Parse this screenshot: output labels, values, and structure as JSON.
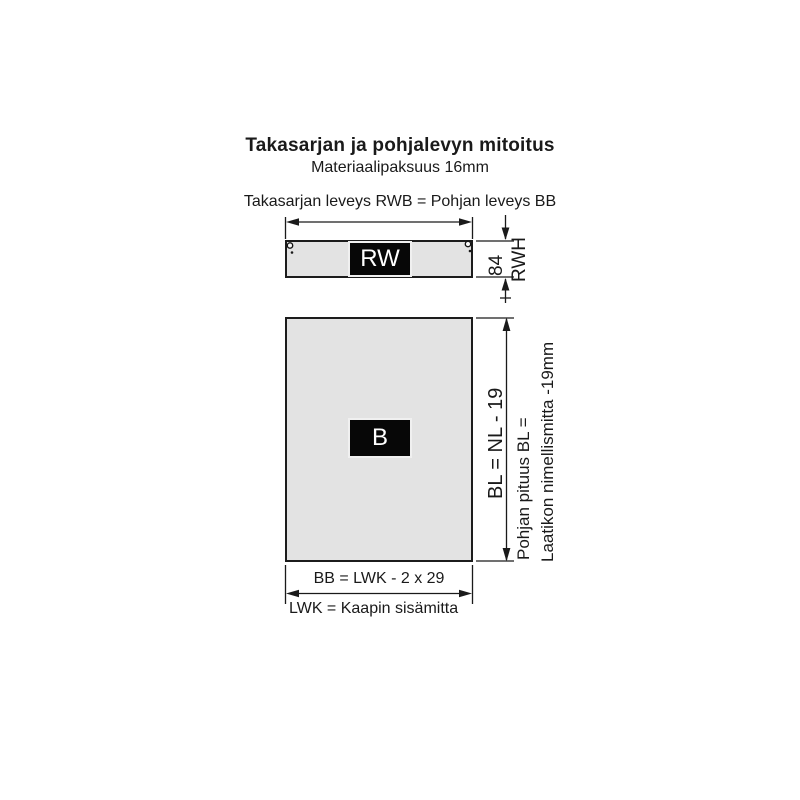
{
  "header": {
    "title": "Takasarjan ja pohjalevyn mitoitus",
    "subtitle": "Materiaalipaksuus 16mm"
  },
  "top_caption": "Takasarjan leveys RWB = Pohjan leveys BB",
  "back_rail": {
    "label": "RW",
    "height_value": "84",
    "height_code": "RWH"
  },
  "bottom_panel": {
    "label": "B",
    "length_equation": "BL = NL - 19",
    "length_note_line1": "Pohjan pituus BL =",
    "length_note_line2": "Laatikon nimellismitta -19mm",
    "width_equation": "BB = LWK - 2 x 29",
    "lwk_note": "LWK = Kaapin sisämitta"
  },
  "icons": {
    "screw_hole": "circle-outline",
    "pilot_dot": "filled-dot"
  },
  "colors": {
    "panel_fill": "#e3e3e3",
    "panel_border": "#1c1c1c",
    "line": "#1a1a1a",
    "label_bg": "#070707",
    "label_text": "#ffffff",
    "background": "#ffffff"
  }
}
